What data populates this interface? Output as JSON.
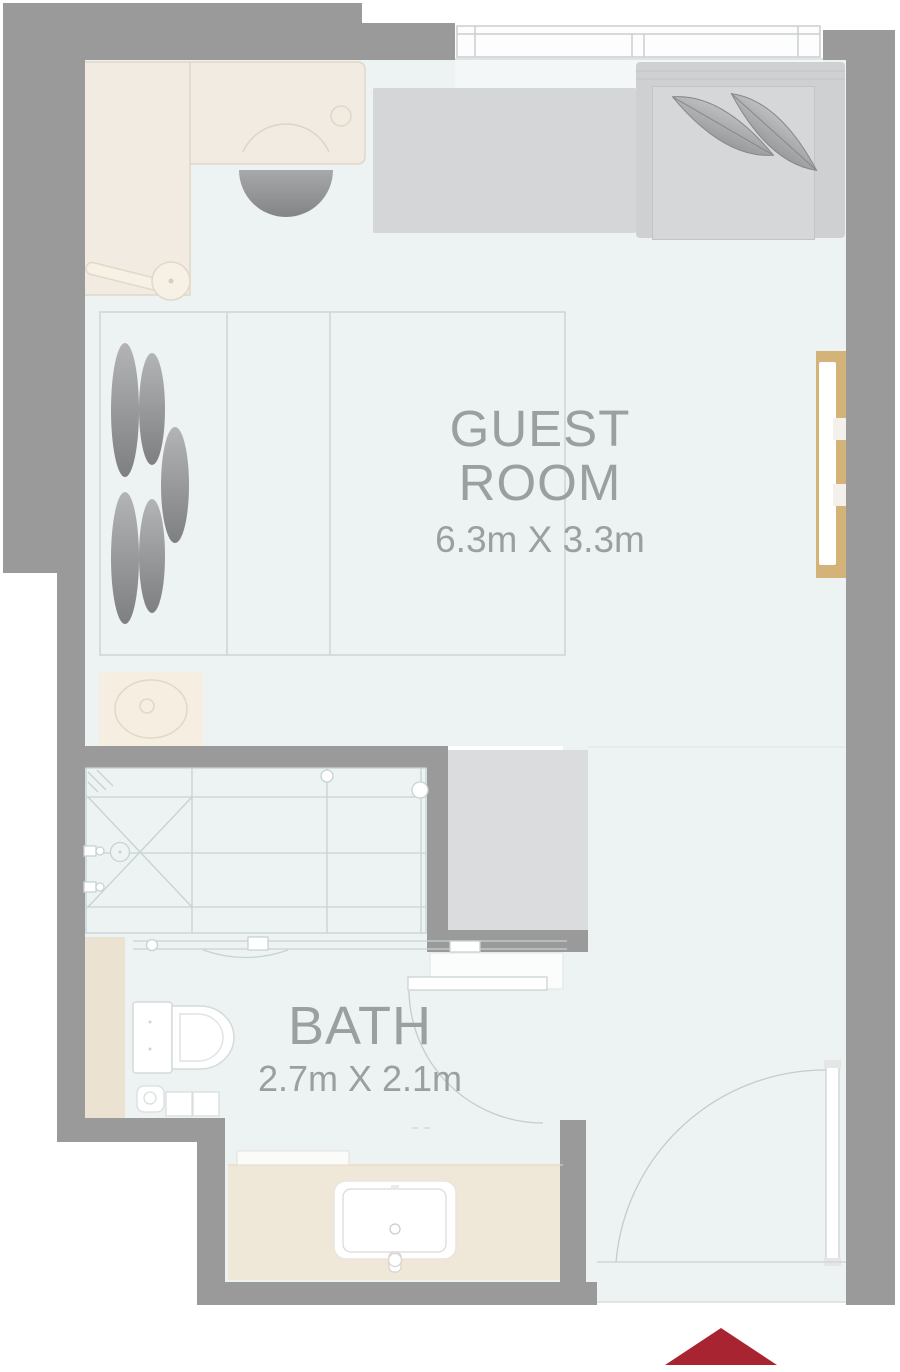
{
  "title": "Hotel guest room floor plan",
  "rooms": {
    "guest_room": {
      "label": "GUEST ROOM",
      "dimensions": "6.3m X 3.3m"
    },
    "bath": {
      "label": "BATH",
      "dimensions": "2.7m X 2.1m"
    }
  },
  "colors": {
    "wall": "#9a9a9b",
    "floor": "#edf2f2",
    "furniture_beige": "#f1ebe1",
    "furniture_gray": "#d6d7d9",
    "wardrobe_gray": "#dbdcdd",
    "accent_tan_panel": "#d3b377",
    "entry_marker_red": "#a82430",
    "label_text": "#9aa0a0"
  },
  "furniture_icons": [
    "desk-icon",
    "desk-chair-icon",
    "luggage-rack-icon",
    "bed-pillows-icon",
    "daybed-icon",
    "lounge-chair-icon",
    "leaf-cushion-icon",
    "window-icon",
    "tv-panel-icon",
    "ottoman-icon",
    "wardrobe-icon",
    "shower-icon",
    "glass-partition-icon",
    "toilet-icon",
    "vanity-sink-icon",
    "bath-door-icon",
    "entry-door-icon"
  ],
  "entry_marker": {
    "shape": "triangle-up",
    "color": "#a82430"
  }
}
